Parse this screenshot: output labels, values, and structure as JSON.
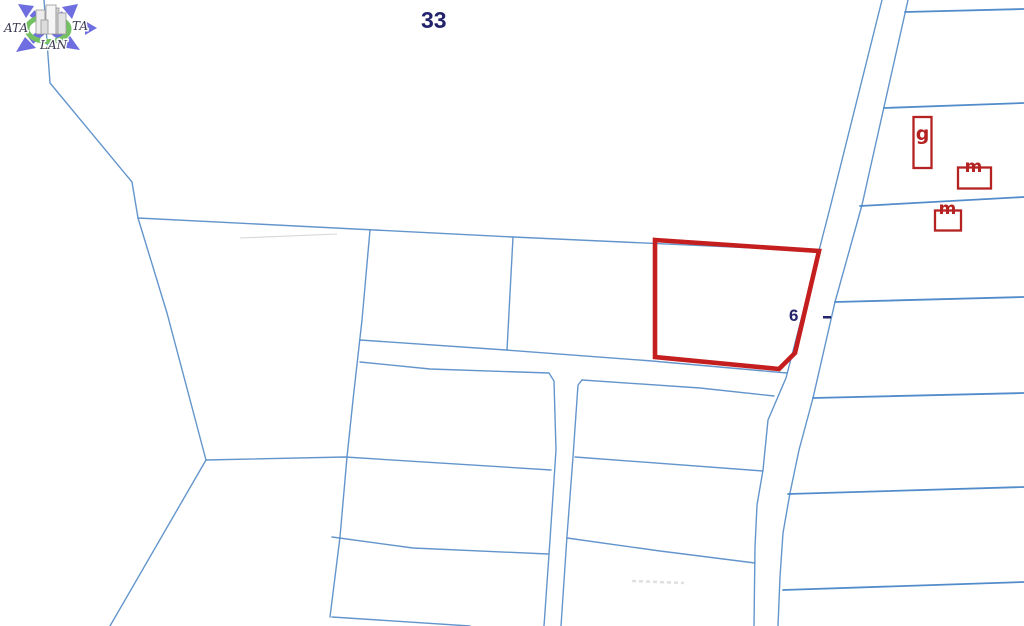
{
  "page": {
    "width": 1024,
    "height": 626,
    "background": "#ffffff"
  },
  "labels": {
    "block_number": "33",
    "parcel_number_partial": "6"
  },
  "logo": {
    "text_left": "ATA",
    "text_right": "TA",
    "text_bottom": "LAN"
  },
  "building_marks": [
    {
      "label": "g"
    },
    {
      "label": "m"
    },
    {
      "label": "m"
    }
  ],
  "colors": {
    "line_blue": "#5b8fc9",
    "divider_blue": "#4a86c8",
    "selected_parcel_red": "#c41e1e",
    "building_mark_red": "#b52222",
    "label_navy": "#23236b",
    "logo_purple": "#6e6ee0",
    "logo_green": "#74c163",
    "faint_gray": "#bbbbbb"
  }
}
